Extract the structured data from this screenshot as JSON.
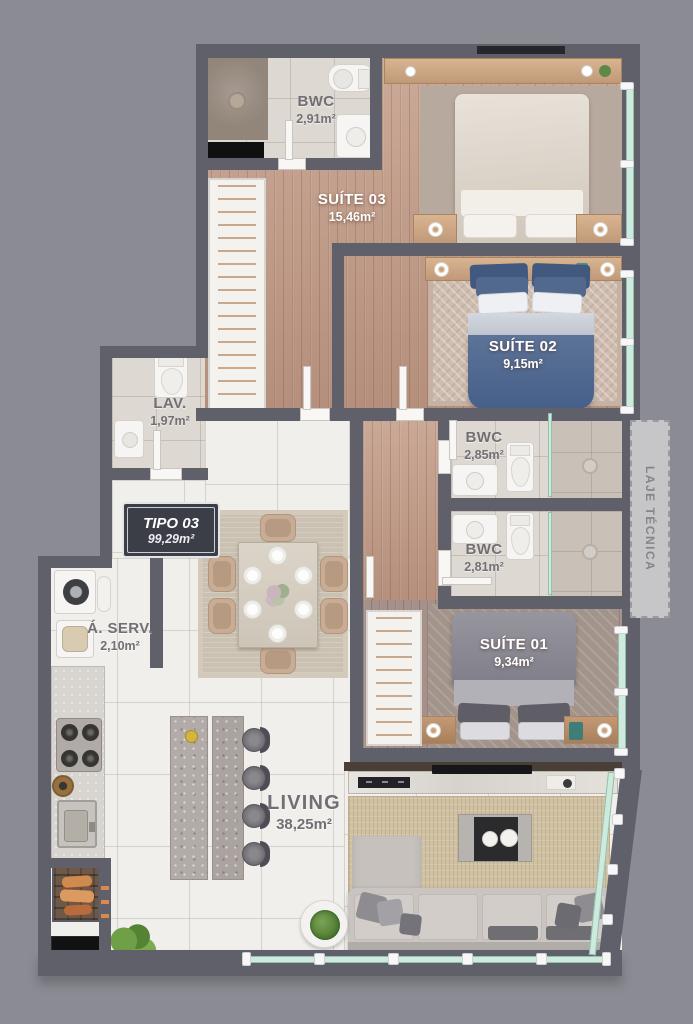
{
  "plan": {
    "badge": {
      "title": "TIPO 03",
      "area": "99,29m²"
    },
    "rooms": {
      "bwc_suite03": {
        "name": "BWC",
        "area": "2,91m²"
      },
      "suite03": {
        "name": "SUÍTE 03",
        "area": "15,46m²"
      },
      "suite02": {
        "name": "SUÍTE 02",
        "area": "9,15m²"
      },
      "lav": {
        "name": "LAV.",
        "area": "1,97m²"
      },
      "bwc_suite02": {
        "name": "BWC",
        "area": "2,85m²"
      },
      "bwc_suite01": {
        "name": "BWC",
        "area": "2,81m²"
      },
      "suite01": {
        "name": "SUÍTE 01",
        "area": "9,34m²"
      },
      "area_servico": {
        "name": "Á. SERV.",
        "area": "2,10m²"
      },
      "living": {
        "name": "LIVING",
        "area": "38,25m²"
      },
      "laje_tecnica": {
        "name": "LAJE TÉCNICA"
      }
    },
    "colors": {
      "background": "#8b8b93",
      "wall": "#5f606a",
      "wood_floor": "#c49e89",
      "wood_floor_gray": "#a5908a",
      "tile": "#f1efec",
      "bath_tile": "#ded8d2",
      "glass": "#cdeadd",
      "bed_blue": "#46608a",
      "bed_gray": "#807e88",
      "living_rug": "#d0c1a3",
      "label_light": "#ffffff",
      "label_dark": "#716f74",
      "badge_bg": "#3c3e47"
    }
  }
}
